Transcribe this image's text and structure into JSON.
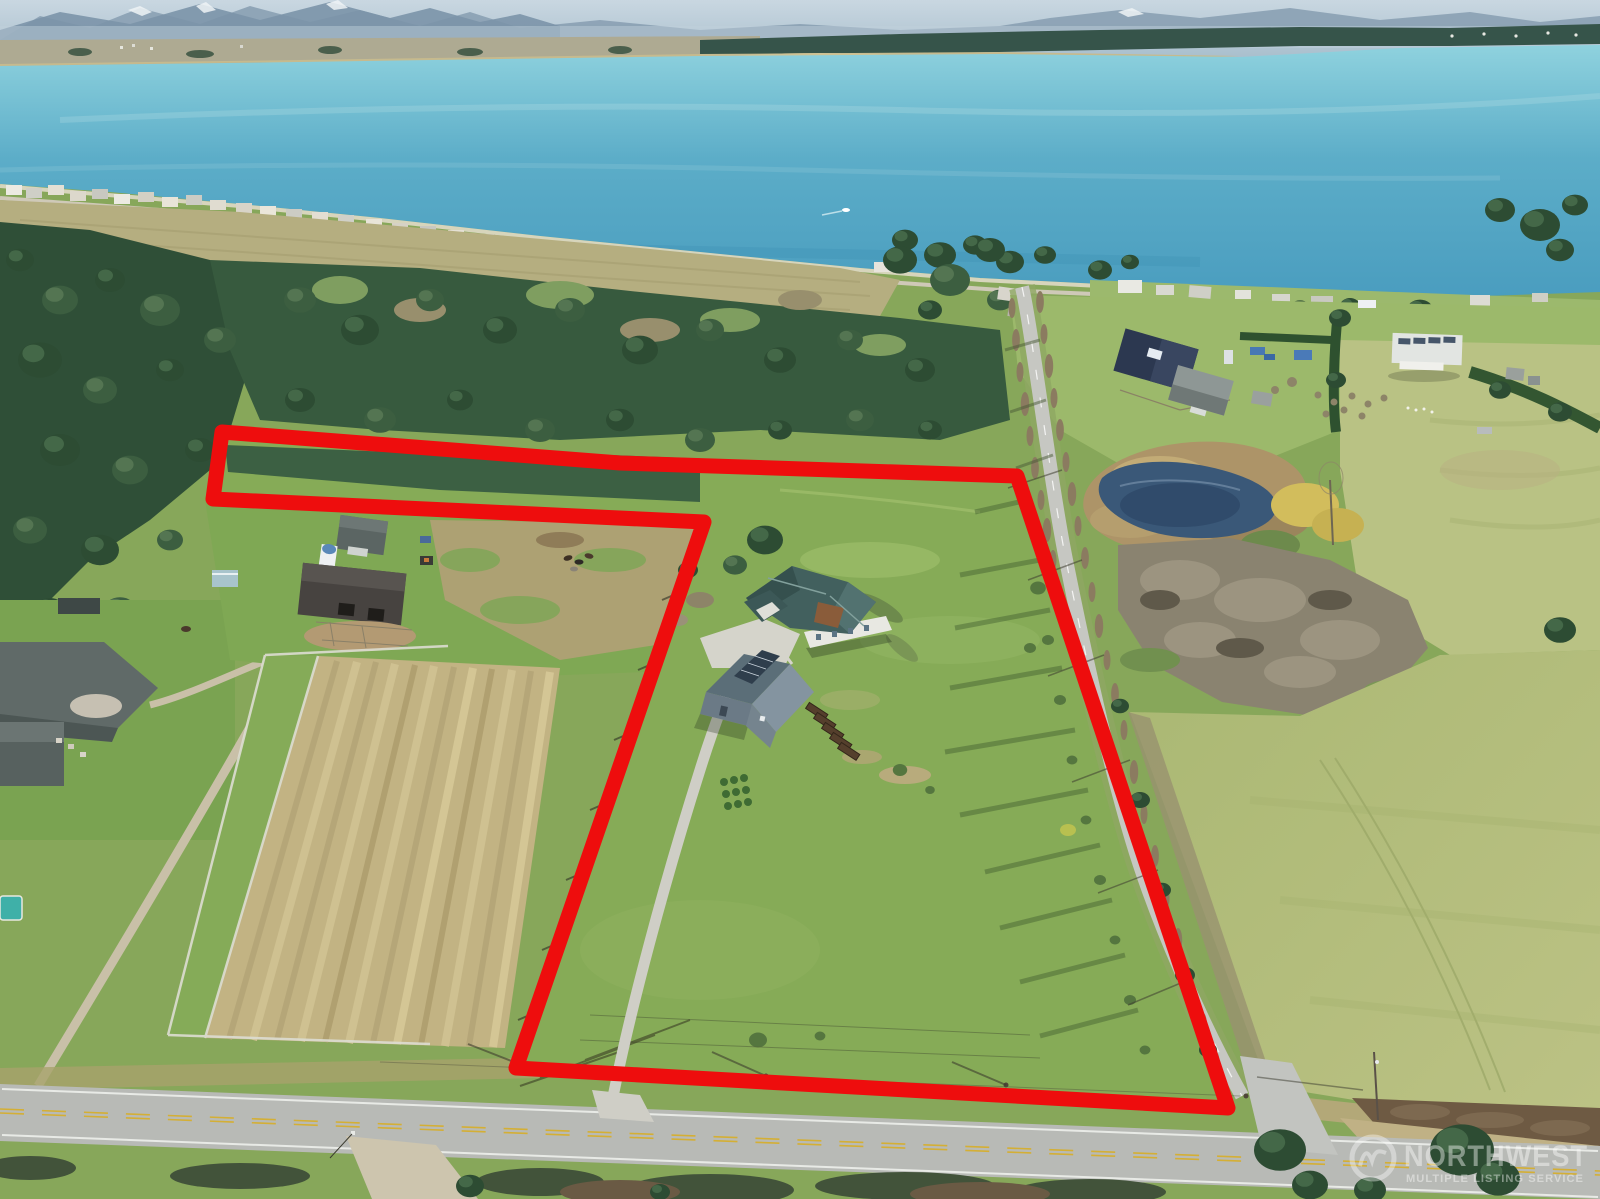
{
  "image": {
    "kind": "aerial-drone-real-estate-photo",
    "description": "Aerial view of a rural waterfront-view acreage property outlined in red, with bay, beach community, evergreen forest, tree-lined country road, pond, neighboring farms and a house with shop building",
    "width": 1600,
    "height": 1199
  },
  "boundary": {
    "points": "222,432 620,463 1017,476 1228,1108 516,1068 704,522 213,499",
    "color": "#ee0d0d",
    "stroke_width": 15
  },
  "watermark": {
    "logo": "nwmls-w-circle-logo",
    "line1": "NORTHWEST",
    "line2": "MULTIPLE LISTING SERVICE",
    "color": "#ffffff",
    "opacity": 0.42
  },
  "scene": {
    "water": "bay with distant shoreline and mountains",
    "outlined_parcel": "L-shaped parcel containing house, shop with solar panels, gravel driveway and pasture",
    "water_color": "#55a9c5",
    "pasture_color": "#86ab57"
  }
}
